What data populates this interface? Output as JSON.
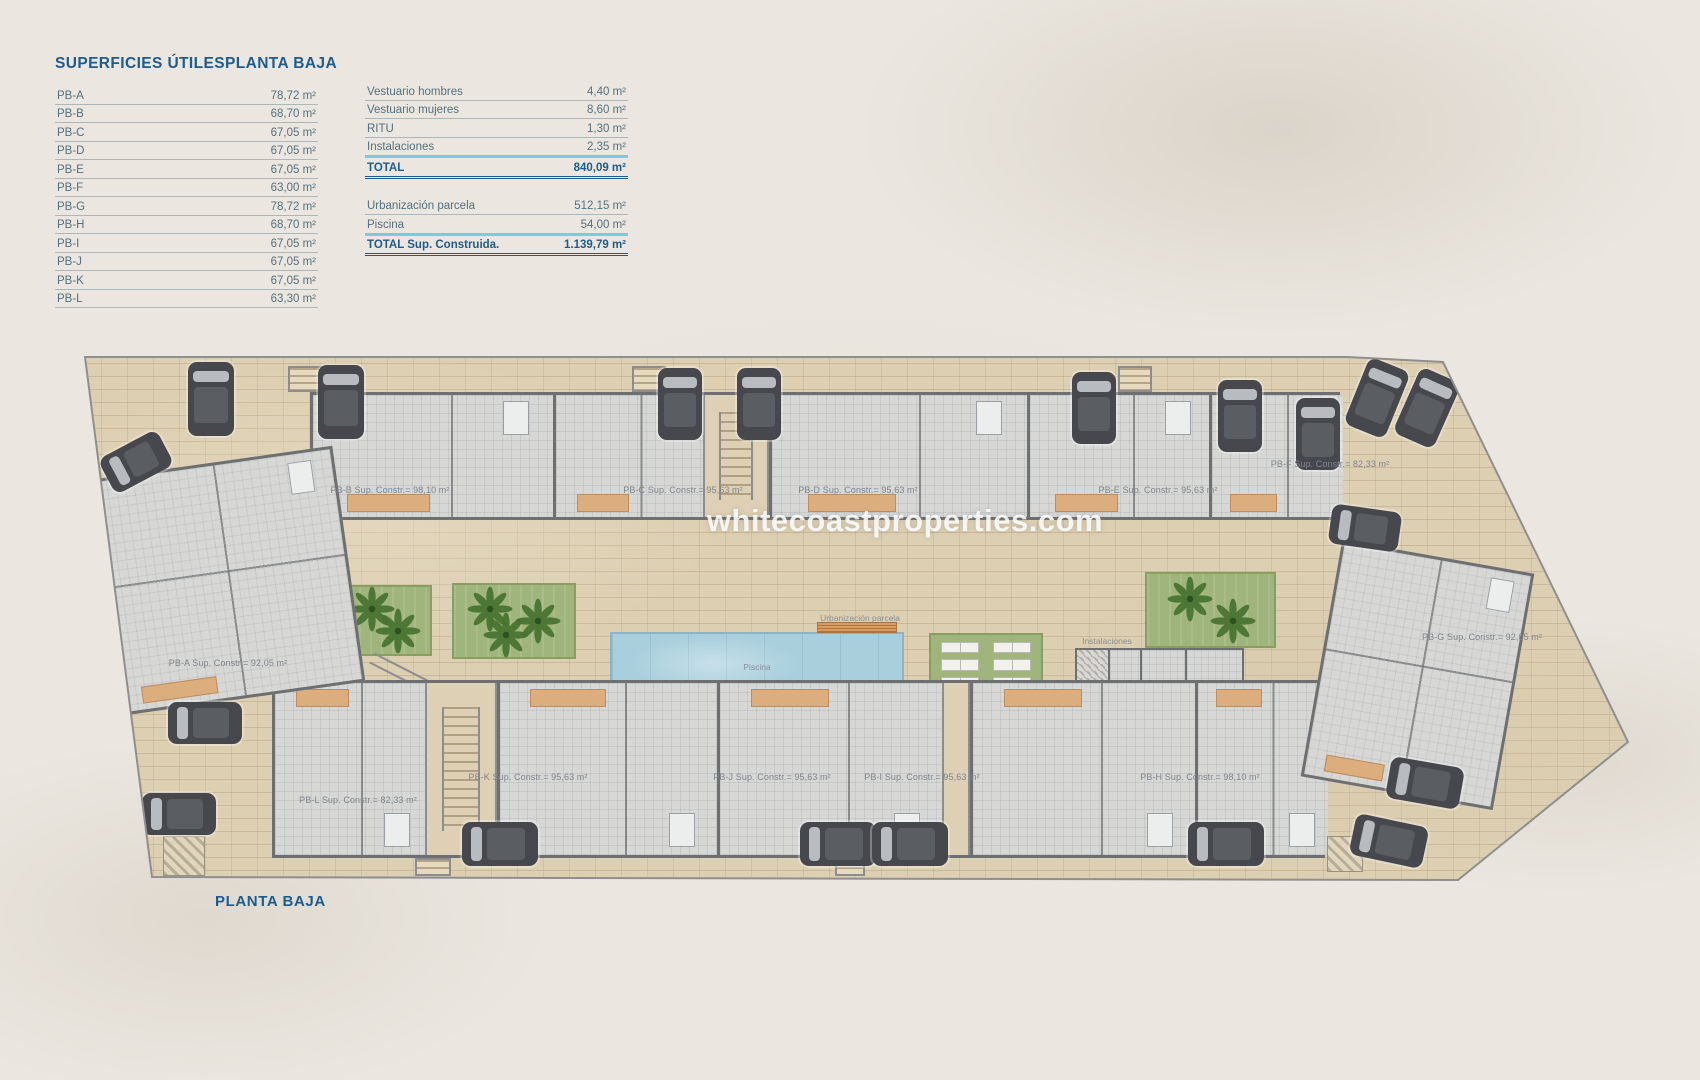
{
  "header": {
    "left_table": {
      "title": "SUPERFICIES ÚTILES",
      "subtitle": "PLANTA BAJA",
      "rows": [
        {
          "label": "PB-A",
          "value": "78,72 m²"
        },
        {
          "label": "PB-B",
          "value": "68,70 m²"
        },
        {
          "label": "PB-C",
          "value": "67,05 m²"
        },
        {
          "label": "PB-D",
          "value": "67,05 m²"
        },
        {
          "label": "PB-E",
          "value": "67,05 m²"
        },
        {
          "label": "PB-F",
          "value": "63,00 m²"
        },
        {
          "label": "PB-G",
          "value": "78,72 m²"
        },
        {
          "label": "PB-H",
          "value": "68,70 m²"
        },
        {
          "label": "PB-I",
          "value": "67,05 m²"
        },
        {
          "label": "PB-J",
          "value": "67,05 m²"
        },
        {
          "label": "PB-K",
          "value": "67,05 m²"
        },
        {
          "label": "PB-L",
          "value": "63,30 m²"
        }
      ]
    },
    "right_table": {
      "rows": [
        {
          "label": "Vestuario hombres",
          "value": "4,40 m²"
        },
        {
          "label": "Vestuario mujeres",
          "value": "8,60 m²"
        },
        {
          "label": "RITU",
          "value": "1,30 m²"
        },
        {
          "label": "Instalaciones",
          "value": "2,35 m²"
        }
      ],
      "total": {
        "label": "TOTAL",
        "value": "840,09 m²"
      },
      "rows2": [
        {
          "label": "Urbanización parcela",
          "value": "512,15 m²"
        },
        {
          "label": "Piscina",
          "value": "54,00 m²"
        }
      ],
      "total2": {
        "label": "TOTAL Sup. Construida.",
        "value": "1.139,79 m²"
      }
    }
  },
  "plan": {
    "watermark": "whitecoastproperties.com",
    "area_labels": {
      "urbanizacion": "Urbanización parcela",
      "piscina": "Piscina",
      "instalaciones": "Instalaciones",
      "ritu": "Ritu",
      "v_hombres": "V.Hombres",
      "v_mujeres": "V.Mujeres"
    },
    "units": [
      {
        "id": "pb-b",
        "label": "PB-B Sup. Constr.= 98,10 m²"
      },
      {
        "id": "pb-c",
        "label": "PB-C Sup. Constr.= 95,63 m²"
      },
      {
        "id": "pb-d",
        "label": "PB-D Sup. Constr.= 95,63 m²"
      },
      {
        "id": "pb-e",
        "label": "PB-E Sup. Constr.= 95,63 m²"
      },
      {
        "id": "pb-f",
        "label": "PB-F Sup. Constr.= 82,33 m²"
      },
      {
        "id": "pb-a",
        "label": "PB-A Sup. Constr.= 92,05 m²"
      },
      {
        "id": "pb-g",
        "label": "PB-G Sup. Constr.= 92,05 m²"
      },
      {
        "id": "pb-l",
        "label": "PB-L Sup. Constr.= 82,33 m²"
      },
      {
        "id": "pb-k",
        "label": "PB-K Sup. Constr.= 95,63 m²"
      },
      {
        "id": "pb-j",
        "label": "PB-J Sup. Constr.= 95,63 m²"
      },
      {
        "id": "pb-i",
        "label": "PB-I Sup. Constr.= 95,63 m²"
      },
      {
        "id": "pb-h",
        "label": "PB-H Sup. Constr.= 98,10 m²"
      }
    ]
  },
  "footer": {
    "title": "PLANTA BAJA"
  },
  "colors": {
    "accent_blue": "#1d5c8d",
    "table_text": "#54707f",
    "total_rule_cyan": "#7ccadf",
    "parcel_beige": "#ddcfb2",
    "wall_gray": "#6e6f71",
    "floor_gray": "#d7d8d6",
    "terrace_orange": "#dcae7e",
    "garden_green": "#9fb57c",
    "pool_blue": "#a9cfdd",
    "car_gray": "#46484d"
  }
}
